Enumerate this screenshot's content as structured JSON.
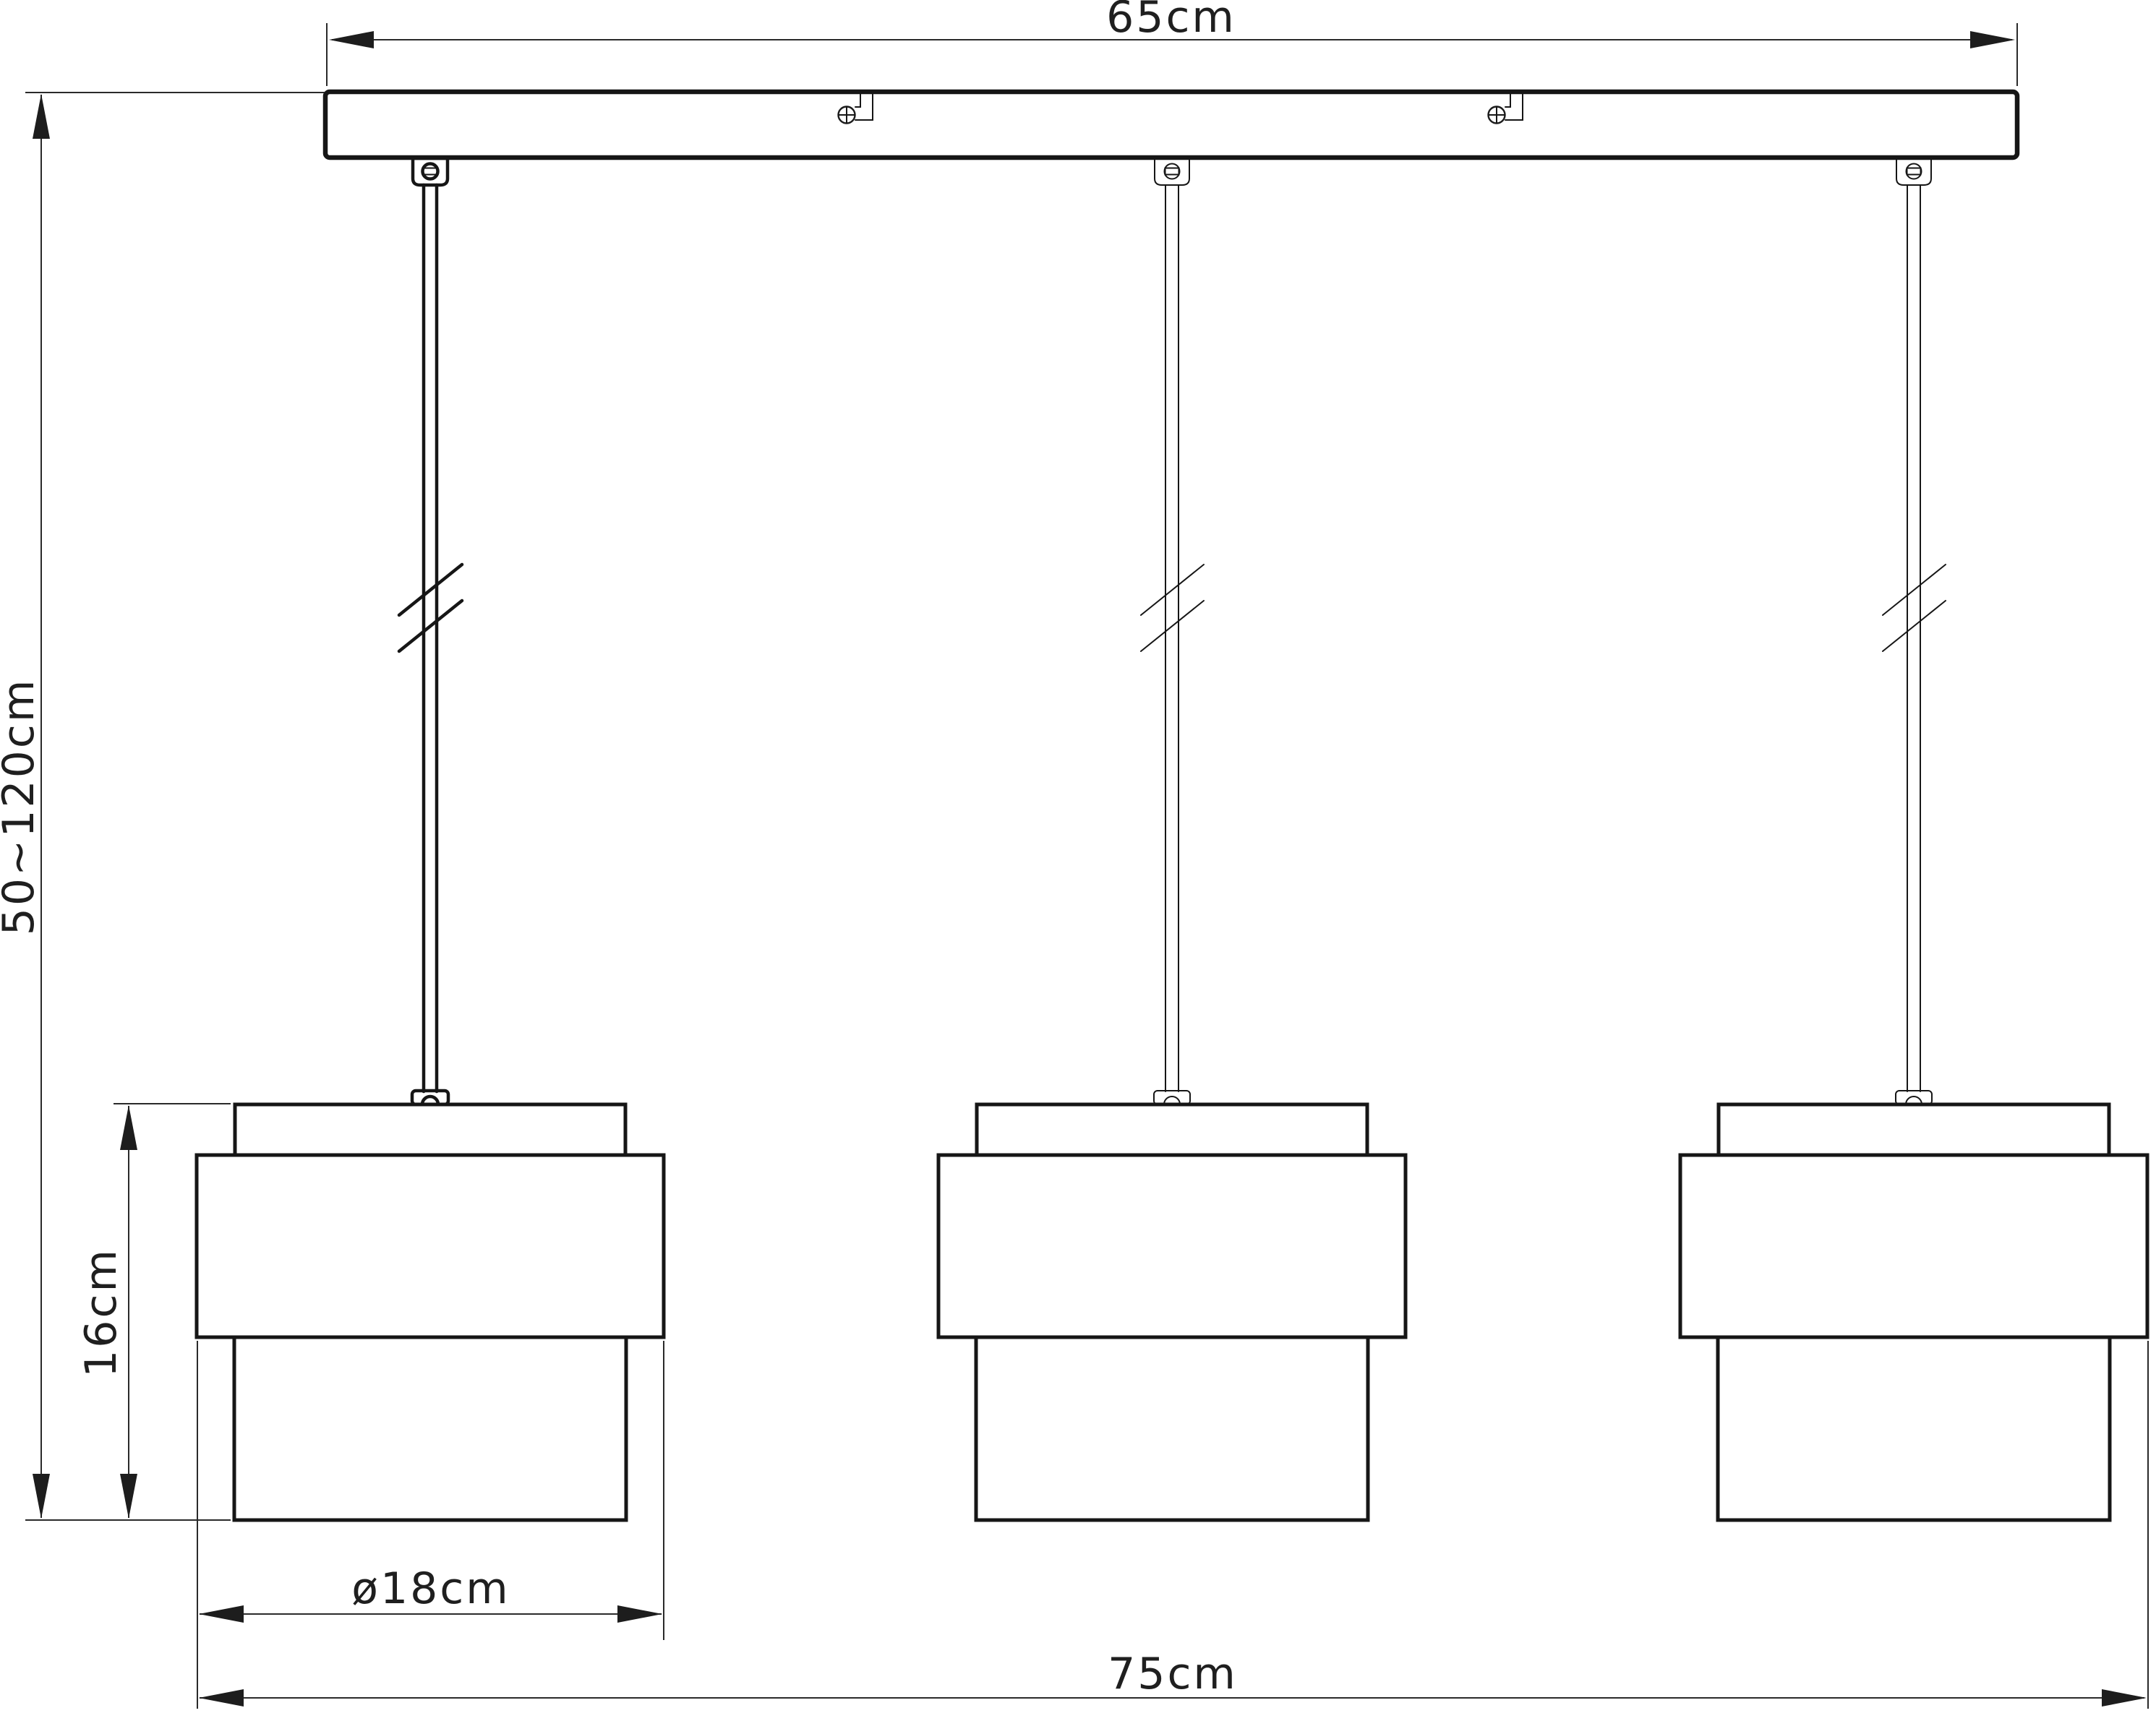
{
  "drawing": {
    "title": "Three-light pendant luminaire — front elevation dimension drawing",
    "background_color": "#ffffff",
    "line_color": "#161616",
    "lamp_count": 3,
    "labels": {
      "canopy_width": "65cm",
      "suspension_height": "50~120cm",
      "shade_height": "16cm",
      "shade_diameter": "ø18cm",
      "fixture_width": "75cm"
    }
  }
}
